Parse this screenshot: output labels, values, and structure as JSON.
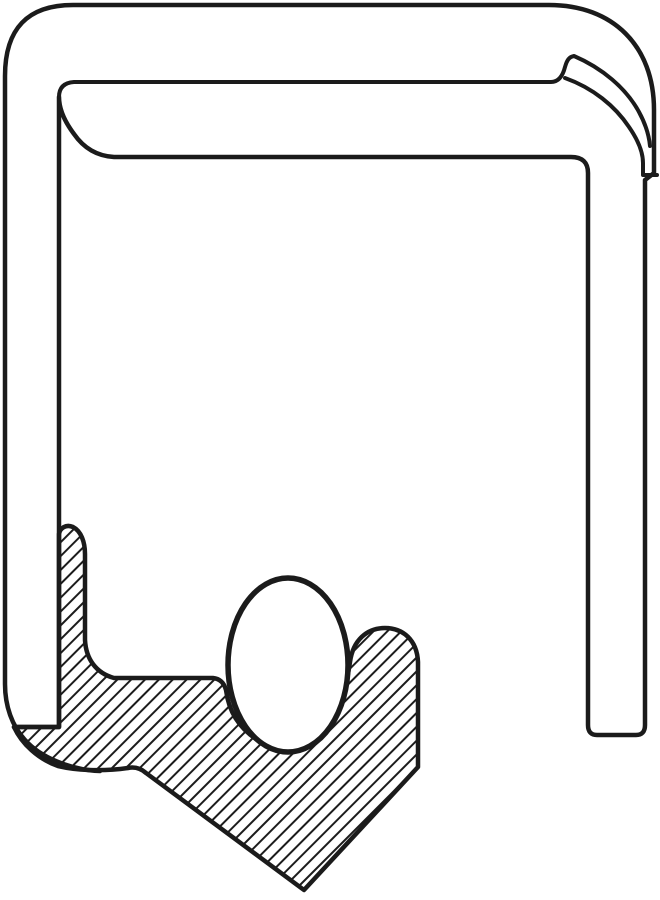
{
  "figure": {
    "description": "Cross-section line drawing of an oil seal: metal outer case with rolled lip, diagonally hatched rubber sealing element with downward-pointing lip, and garter spring shown as white ellipse",
    "canvas": {
      "width": 660,
      "height": 900
    },
    "colors": {
      "line": "#1b1b1b",
      "background": "#ffffff"
    },
    "hatch": {
      "spacing": 9.8,
      "transform": "rotate(-45)",
      "stroke_width": 2
    },
    "stroke_widths": {
      "outline": 4.5,
      "contour": 4,
      "spring": 5.5
    },
    "paths": {
      "case_outline": "M 100 771 C 70 770 40 757 25 740 C 12 726 5 706 5 684 L 5 76 Q 5 5 73 5 L 549 5 C 613 5 654 46 654 110 L 654 173 L 645 180 L 645 725 Q 645 735 636 735 L 597 735 Q 588 735 588 725 L 588 173 Q 588 157 571 157 L 114 157 C 96 156 83 147 74 134 C 65 122 59 110 59 97 L 59 727 L 14 727",
      "lip_upper": "M 59 97 Q 59 83 74 82 L 551 82 C 559 82 563 75 565 67 C 567 60 569 57 574 56 C 602 68 626 88 639 112 C 645 123 649 135 650 146",
      "lip_lower": "M 565 78 C 593 88 615 106 629 127 C 638 140 643 152 643 163 L 643 175 L 657 175",
      "rubber_body": "M 59 534 C 60 528 66 524 73 527 C 81 531 85 542 85 554 L 85 640 C 86 659 96 673 114 678 L 213 678 Q 223 679 226 690 Q 232 737 286 752 Q 339 740 350 662 C 353 640 367 628 385 628 C 403 628 417 640 418 662 L 418 767 L 304 890 L 146 773 Q 138 766 128 768 C 100 772 75 770 58 766 C 38 759 22 744 14 727 L 59 727 Z"
    },
    "spring": {
      "cx": 288,
      "cy": 665,
      "rx": 60,
      "ry": 87
    }
  }
}
